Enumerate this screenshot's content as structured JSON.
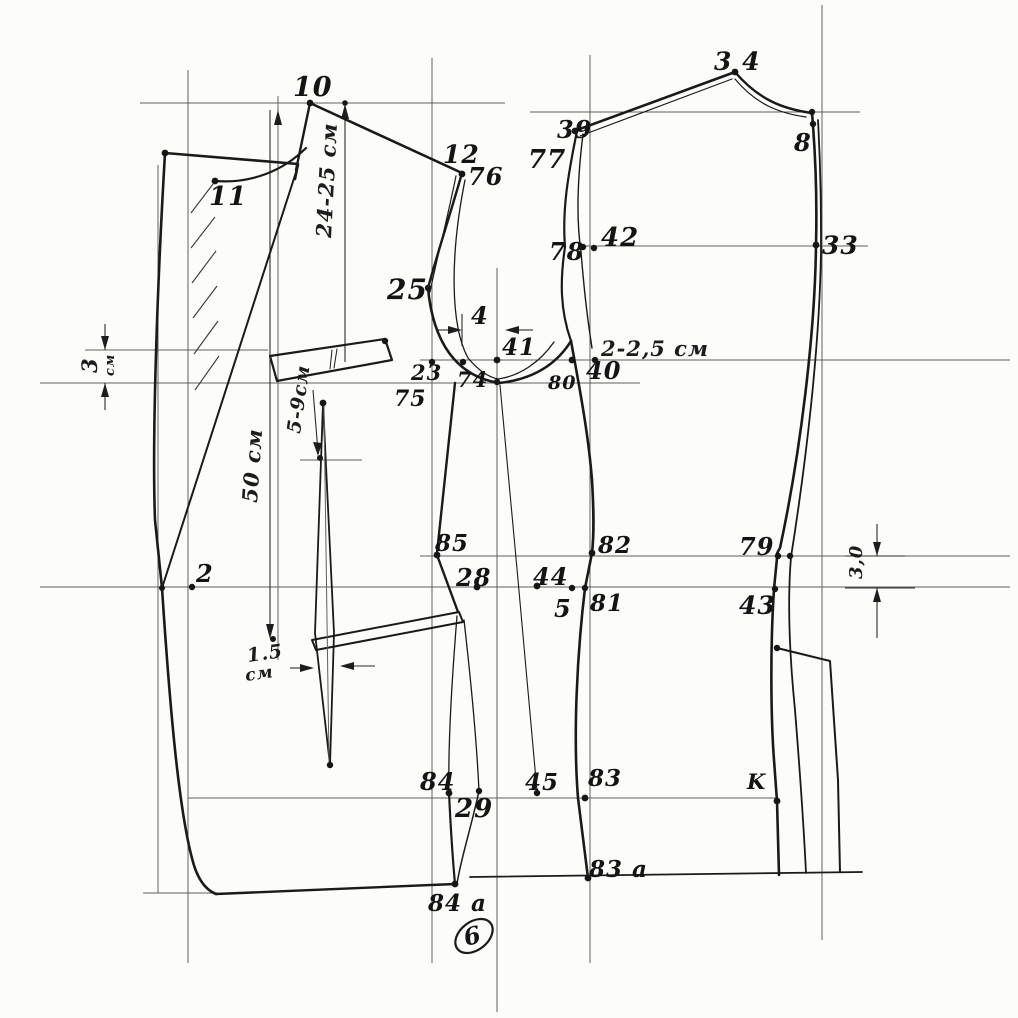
{
  "sheet": {
    "number": "6"
  },
  "colors": {
    "ink": "#1a1a1a",
    "construction": "#5f5f5f",
    "paper": "#fcfcfa"
  },
  "units": "см",
  "point_labels": [
    {
      "id": "10",
      "text": "10",
      "x": 293,
      "y": 96,
      "size": 27
    },
    {
      "id": "11",
      "text": "11",
      "x": 209,
      "y": 205,
      "size": 26
    },
    {
      "id": "12",
      "text": "12",
      "x": 443,
      "y": 163,
      "size": 25
    },
    {
      "id": "76",
      "text": "76",
      "x": 468,
      "y": 185,
      "size": 24
    },
    {
      "id": "25",
      "text": "25",
      "x": 387,
      "y": 299,
      "size": 28
    },
    {
      "id": "4",
      "text": "4",
      "x": 471,
      "y": 324,
      "size": 24
    },
    {
      "id": "41",
      "text": "41",
      "x": 502,
      "y": 355,
      "size": 23
    },
    {
      "id": "23",
      "text": "23",
      "x": 411,
      "y": 380,
      "size": 21
    },
    {
      "id": "74",
      "text": "74",
      "x": 457,
      "y": 387,
      "size": 21
    },
    {
      "id": "80",
      "text": "80",
      "x": 548,
      "y": 389,
      "size": 19
    },
    {
      "id": "40",
      "text": "40",
      "x": 586,
      "y": 379,
      "size": 24
    },
    {
      "id": "75",
      "text": "75",
      "x": 394,
      "y": 406,
      "size": 22
    },
    {
      "id": "39",
      "text": "39",
      "x": 557,
      "y": 138,
      "size": 24
    },
    {
      "id": "77",
      "text": "77",
      "x": 528,
      "y": 168,
      "size": 26
    },
    {
      "id": "78",
      "text": "78",
      "x": 549,
      "y": 260,
      "size": 24
    },
    {
      "id": "42",
      "text": "42",
      "x": 601,
      "y": 246,
      "size": 26
    },
    {
      "id": "34",
      "text": "3 4",
      "x": 714,
      "y": 70,
      "size": 25
    },
    {
      "id": "8",
      "text": "8",
      "x": 794,
      "y": 151,
      "size": 24
    },
    {
      "id": "33",
      "text": "33",
      "x": 822,
      "y": 254,
      "size": 25
    },
    {
      "id": "2",
      "text": "2",
      "x": 196,
      "y": 582,
      "size": 24
    },
    {
      "id": "85",
      "text": "85",
      "x": 435,
      "y": 551,
      "size": 23
    },
    {
      "id": "28",
      "text": "28",
      "x": 456,
      "y": 586,
      "size": 24
    },
    {
      "id": "44",
      "text": "44",
      "x": 533,
      "y": 585,
      "size": 24
    },
    {
      "id": "82",
      "text": "82",
      "x": 598,
      "y": 553,
      "size": 23
    },
    {
      "id": "5",
      "text": "5",
      "x": 554,
      "y": 617,
      "size": 24
    },
    {
      "id": "81",
      "text": "81",
      "x": 590,
      "y": 611,
      "size": 23
    },
    {
      "id": "79",
      "text": "79",
      "x": 739,
      "y": 555,
      "size": 24
    },
    {
      "id": "43",
      "text": "43",
      "x": 739,
      "y": 614,
      "size": 25
    },
    {
      "id": "84",
      "text": "84",
      "x": 420,
      "y": 790,
      "size": 24
    },
    {
      "id": "29",
      "text": "29",
      "x": 455,
      "y": 817,
      "size": 26
    },
    {
      "id": "45",
      "text": "45",
      "x": 525,
      "y": 790,
      "size": 23
    },
    {
      "id": "83",
      "text": "83",
      "x": 588,
      "y": 786,
      "size": 23
    },
    {
      "id": "k",
      "text": "K",
      "x": 747,
      "y": 789,
      "size": 21
    },
    {
      "id": "83a",
      "text": "83 a",
      "x": 589,
      "y": 877,
      "size": 23
    },
    {
      "id": "84a",
      "text": "84 a",
      "x": 428,
      "y": 911,
      "size": 23
    }
  ],
  "measurements": [
    {
      "id": "back-depth",
      "text": "24-25 см",
      "x": 331,
      "y": 238,
      "rot": -87,
      "size": 21
    },
    {
      "id": "gorge-width",
      "text": "2-2,5 см",
      "x": 601,
      "y": 356,
      "rot": 0,
      "size": 21
    },
    {
      "id": "overlap-value",
      "text": "3",
      "x": 97,
      "y": 373,
      "rot": -90,
      "size": 21
    },
    {
      "id": "overlap-unit",
      "text": "см",
      "x": 114,
      "y": 376,
      "rot": -90,
      "size": 13
    },
    {
      "id": "pocket-drop",
      "text": "5-9см",
      "x": 300,
      "y": 434,
      "rot": -82,
      "size": 19
    },
    {
      "id": "length",
      "text": "50 см",
      "x": 257,
      "y": 503,
      "rot": -86,
      "size": 21
    },
    {
      "id": "dart-width-value",
      "text": "1.5",
      "x": 248,
      "y": 662,
      "rot": -8,
      "size": 19
    },
    {
      "id": "dart-width-unit",
      "text": "см",
      "x": 246,
      "y": 681,
      "rot": -8,
      "size": 17
    },
    {
      "id": "side-ease",
      "text": "3,0",
      "x": 862,
      "y": 579,
      "rot": -90,
      "size": 18
    }
  ]
}
